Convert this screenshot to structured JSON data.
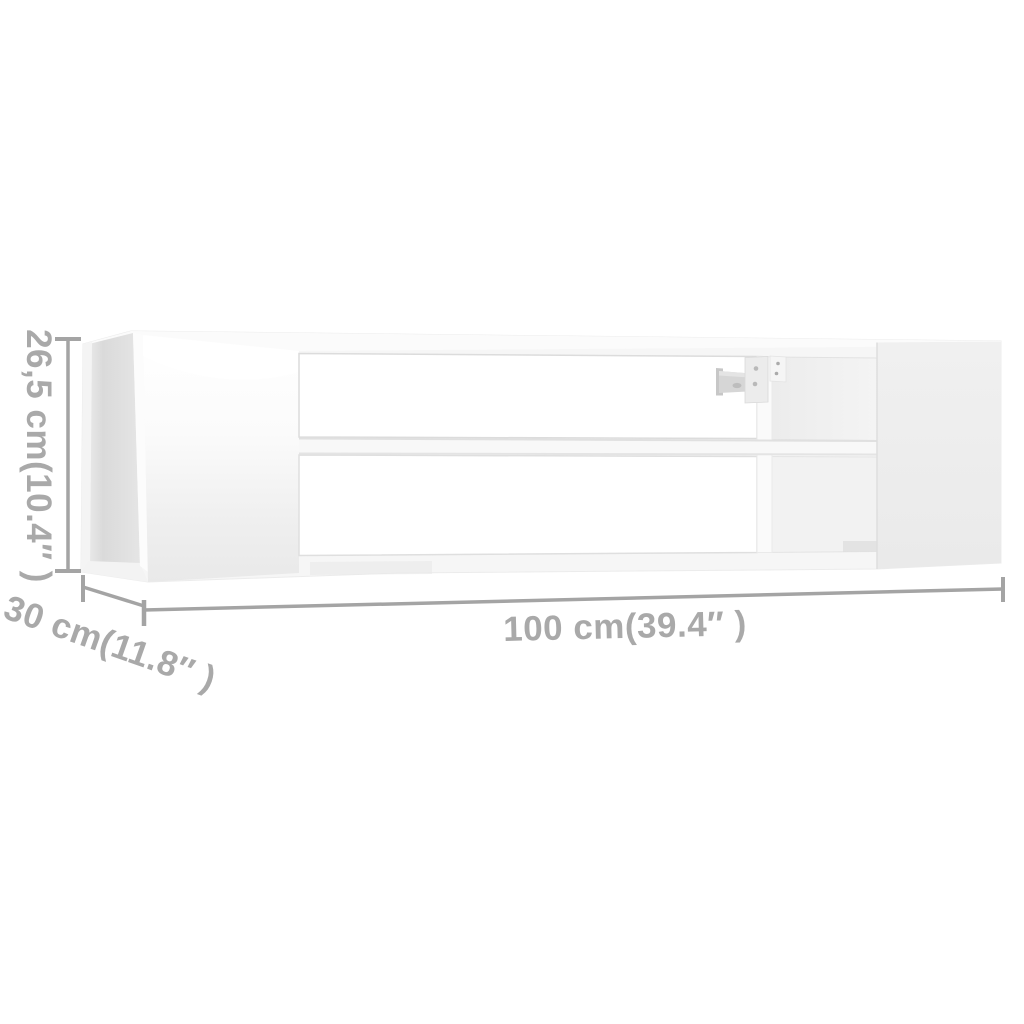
{
  "colors": {
    "background": "#ffffff",
    "dimension_line": "#a4a4a4",
    "dimension_text": "#a9a9a9",
    "cabinet_body": "#f6f6f6",
    "cabinet_interior_shadow": "#dadada",
    "right_panel": "#ededed"
  },
  "dimensions": {
    "height": {
      "label": "26,5 cm(10.4″ )",
      "orientation": "vertical-left"
    },
    "depth": {
      "label": "30 cm(11.8″ )",
      "orientation": "diagonal-bottom-left"
    },
    "width": {
      "label": "100 cm(39.4″ )",
      "orientation": "horizontal-bottom"
    }
  }
}
